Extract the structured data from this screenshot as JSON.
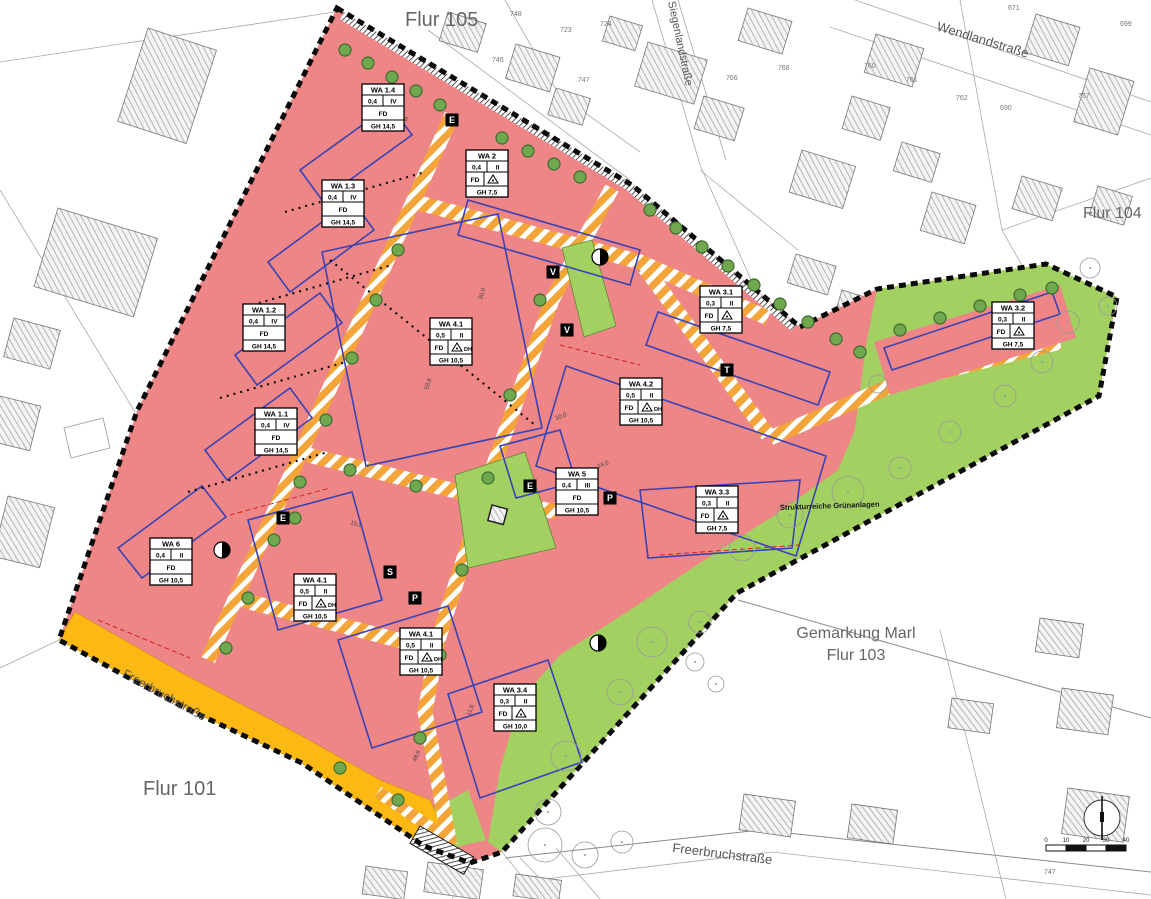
{
  "map_title": "Bebauungsplan Wohngebiet (Gemarkung Marl)",
  "labels": {
    "flur105": "Flur 105",
    "flur104": "Flur 104",
    "flur101": "Flur 101",
    "gemarkung": "Gemarkung Marl",
    "flur103": "Flur 103",
    "wendland": "Wendlandstraße",
    "siegenland": "Siegenlandstraße",
    "freerbruch_band": "Freerbruchstraße",
    "freerbruch_south": "Freerbruchstraße",
    "gruen": "Strukturreiche Grünanlagen"
  },
  "colors": {
    "residential_red": "#ee8586",
    "green_space": "#a2d162",
    "road_orange": "#f3a53a",
    "street_band_yellow": "#fdb913",
    "boundary_black": "#0a0a0a",
    "envelope_blue": "#3a43b5",
    "tree_green": "#6fa84e",
    "hatch_gray": "#9a9a9a"
  },
  "wa_boxes": [
    {
      "id": "WA 1.4",
      "grz": "0,4",
      "fl": "IV",
      "roof": "FD",
      "dh": "",
      "icon": false,
      "gh": "GH 14,5",
      "x": 362,
      "y": 84
    },
    {
      "id": "WA 2",
      "grz": "0,4",
      "fl": "II",
      "roof": "FD",
      "dh": "",
      "icon": true,
      "gh": "GH 7,5",
      "x": 466,
      "y": 150
    },
    {
      "id": "WA 1.3",
      "grz": "0,4",
      "fl": "IV",
      "roof": "FD",
      "dh": "",
      "icon": false,
      "gh": "GH 14,5",
      "x": 322,
      "y": 180
    },
    {
      "id": "WA 1.2",
      "grz": "0,4",
      "fl": "IV",
      "roof": "FD",
      "dh": "",
      "icon": false,
      "gh": "GH 14,5",
      "x": 243,
      "y": 304
    },
    {
      "id": "WA 3.1",
      "grz": "0,3",
      "fl": "II",
      "roof": "FD",
      "dh": "",
      "icon": true,
      "gh": "GH 7,5",
      "x": 700,
      "y": 286
    },
    {
      "id": "WA 3.2",
      "grz": "0,3",
      "fl": "II",
      "roof": "FD",
      "dh": "",
      "icon": true,
      "gh": "GH 7,5",
      "x": 992,
      "y": 302
    },
    {
      "id": "WA 4.1",
      "grz": "0,5",
      "fl": "II",
      "roof": "FD",
      "dh": "DH",
      "icon": true,
      "gh": "GH 10,5",
      "x": 430,
      "y": 318
    },
    {
      "id": "WA 4.2",
      "grz": "0,5",
      "fl": "II",
      "roof": "FD",
      "dh": "DH",
      "icon": true,
      "gh": "GH 10,5",
      "x": 620,
      "y": 378
    },
    {
      "id": "WA 1.1",
      "grz": "0,4",
      "fl": "IV",
      "roof": "FD",
      "dh": "",
      "icon": false,
      "gh": "GH 14,5",
      "x": 255,
      "y": 408
    },
    {
      "id": "WA 5",
      "grz": "0,4",
      "fl": "III",
      "roof": "FD",
      "dh": "",
      "icon": false,
      "gh": "GH 10,5",
      "x": 556,
      "y": 468
    },
    {
      "id": "WA 3.3",
      "grz": "0,3",
      "fl": "II",
      "roof": "FD",
      "dh": "",
      "icon": true,
      "gh": "GH 7,5",
      "x": 696,
      "y": 486
    },
    {
      "id": "WA 6",
      "grz": "0,4",
      "fl": "II",
      "roof": "FD",
      "dh": "",
      "icon": false,
      "gh": "GH 10,5",
      "x": 150,
      "y": 538
    },
    {
      "id": "WA 4.1",
      "grz": "0,5",
      "fl": "II",
      "roof": "FD",
      "dh": "DH",
      "icon": true,
      "gh": "GH 10,5",
      "x": 294,
      "y": 574
    },
    {
      "id": "WA 4.1",
      "grz": "0,5",
      "fl": "II",
      "roof": "FD",
      "dh": "DH",
      "icon": true,
      "gh": "GH 10,5",
      "x": 400,
      "y": 628
    },
    {
      "id": "WA 3.4",
      "grz": "0,3",
      "fl": "II",
      "roof": "FD",
      "dh": "",
      "icon": true,
      "gh": "GH 10,0",
      "x": 494,
      "y": 684
    }
  ],
  "markers": [
    {
      "g": "E",
      "x": 452,
      "y": 120
    },
    {
      "g": "V",
      "x": 553,
      "y": 272
    },
    {
      "g": "V",
      "x": 567,
      "y": 330
    },
    {
      "g": "T",
      "x": 727,
      "y": 370
    },
    {
      "g": "E",
      "x": 283,
      "y": 518
    },
    {
      "g": "S",
      "x": 390,
      "y": 572
    },
    {
      "g": "P",
      "x": 415,
      "y": 598
    },
    {
      "g": "P",
      "x": 610,
      "y": 498
    },
    {
      "g": "E",
      "x": 530,
      "y": 486
    }
  ],
  "signs": [
    {
      "x": 222,
      "y": 550
    },
    {
      "x": 600,
      "y": 257
    },
    {
      "x": 598,
      "y": 643
    }
  ],
  "parcel_numbers": [
    {
      "n": "748",
      "x": 510,
      "y": 16
    },
    {
      "n": "723",
      "x": 560,
      "y": 32
    },
    {
      "n": "724",
      "x": 600,
      "y": 26
    },
    {
      "n": "746",
      "x": 492,
      "y": 62
    },
    {
      "n": "747",
      "x": 578,
      "y": 82
    },
    {
      "n": "766",
      "x": 726,
      "y": 80
    },
    {
      "n": "768",
      "x": 778,
      "y": 70
    },
    {
      "n": "760",
      "x": 864,
      "y": 68
    },
    {
      "n": "761",
      "x": 906,
      "y": 82
    },
    {
      "n": "762",
      "x": 956,
      "y": 100
    },
    {
      "n": "690",
      "x": 1000,
      "y": 110
    },
    {
      "n": "671",
      "x": 1008,
      "y": 10
    },
    {
      "n": "757",
      "x": 1078,
      "y": 98
    },
    {
      "n": "699",
      "x": 1120,
      "y": 26
    },
    {
      "n": "747",
      "x": 1044,
      "y": 874
    }
  ],
  "dimension_labels": [
    {
      "t": "58,8",
      "x": 428,
      "y": 390,
      "r": -73
    },
    {
      "t": "30,0",
      "x": 482,
      "y": 300,
      "r": -73
    },
    {
      "t": "15,0",
      "x": 350,
      "y": 524,
      "r": 17
    },
    {
      "t": "11,6",
      "x": 470,
      "y": 716,
      "r": -69
    },
    {
      "t": "48,6",
      "x": 416,
      "y": 762,
      "r": -69
    },
    {
      "t": "59,6",
      "x": 396,
      "y": 118,
      "r": 17
    },
    {
      "t": "10,0",
      "x": 556,
      "y": 420,
      "r": -20
    },
    {
      "t": "14,0",
      "x": 598,
      "y": 468,
      "r": -20
    }
  ],
  "scalebar": {
    "ticks": [
      "0",
      "10",
      "20",
      "30",
      "40"
    ]
  },
  "trees_small": [
    [
      345,
      50
    ],
    [
      368,
      63
    ],
    [
      392,
      77
    ],
    [
      416,
      91
    ],
    [
      440,
      105
    ],
    [
      502,
      138
    ],
    [
      528,
      151
    ],
    [
      554,
      164
    ],
    [
      580,
      177
    ],
    [
      650,
      210
    ],
    [
      676,
      228
    ],
    [
      702,
      247
    ],
    [
      728,
      266
    ],
    [
      754,
      285
    ],
    [
      780,
      304
    ],
    [
      808,
      322
    ],
    [
      836,
      339
    ],
    [
      860,
      352
    ],
    [
      900,
      330
    ],
    [
      940,
      318
    ],
    [
      980,
      306
    ],
    [
      1020,
      295
    ],
    [
      1052,
      288
    ],
    [
      398,
      250
    ],
    [
      376,
      300
    ],
    [
      352,
      358
    ],
    [
      326,
      420
    ],
    [
      300,
      482
    ],
    [
      274,
      540
    ],
    [
      248,
      598
    ],
    [
      226,
      648
    ],
    [
      540,
      300
    ],
    [
      510,
      395
    ],
    [
      488,
      478
    ],
    [
      462,
      570
    ],
    [
      440,
      655
    ],
    [
      420,
      738
    ],
    [
      350,
      470
    ],
    [
      416,
      486
    ],
    [
      398,
      800
    ],
    [
      340,
      768
    ],
    [
      295,
      518
    ]
  ],
  "trees_outline": [
    [
      848,
      492,
      16
    ],
    [
      790,
      515,
      13
    ],
    [
      742,
      548,
      13
    ],
    [
      900,
      468,
      11
    ],
    [
      950,
      432,
      11
    ],
    [
      1005,
      396,
      11
    ],
    [
      1042,
      362,
      11
    ],
    [
      1068,
      322,
      11
    ],
    [
      652,
      642,
      15
    ],
    [
      700,
      622,
      11
    ],
    [
      620,
      692,
      13
    ],
    [
      566,
      756,
      15
    ],
    [
      548,
      812,
      13
    ],
    [
      545,
      845,
      17
    ],
    [
      585,
      855,
      13
    ],
    [
      622,
      842,
      11
    ],
    [
      695,
      662,
      9
    ],
    [
      716,
      684,
      8
    ],
    [
      878,
      384,
      9
    ],
    [
      1090,
      268,
      10
    ],
    [
      1108,
      306,
      9
    ]
  ]
}
